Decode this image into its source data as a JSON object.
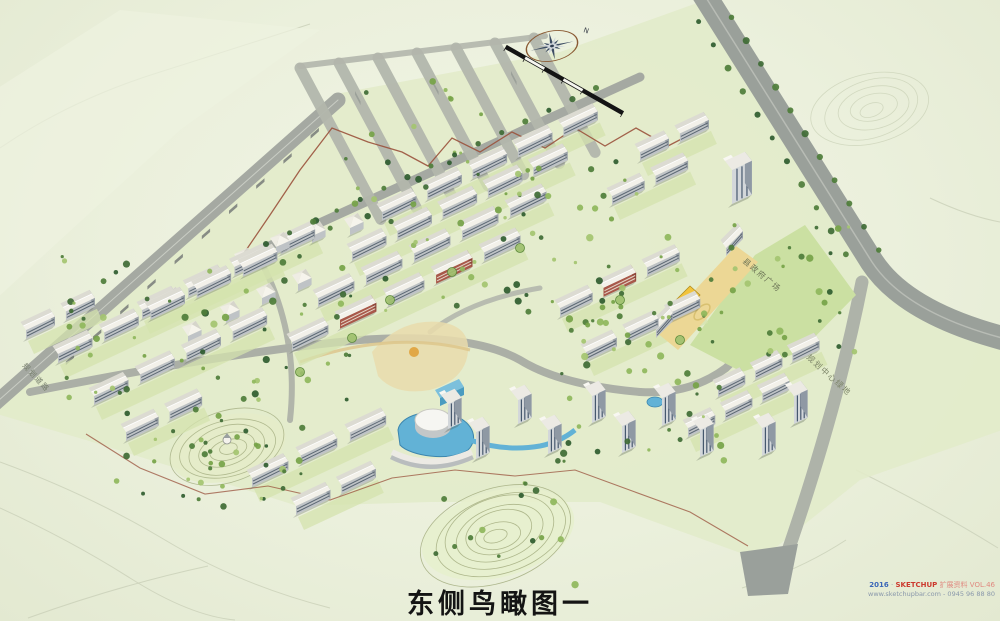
{
  "page": {
    "title": "东侧鸟瞰图一"
  },
  "compass": {
    "north_label": "N"
  },
  "map_labels": {
    "left_road_label": "规划道路",
    "plaza_label": "县政府广场",
    "central_green_label": "规划中心绿地"
  },
  "watermark": {
    "year": "2016",
    "separator": "·",
    "brand": "SKETCHUP",
    "series": "扩展资料 VOL.46",
    "line2": "www.sketchupbar.com - 0945 96 88 80"
  },
  "palette": {
    "paper": "#ecf0de",
    "site_green": "#e2ebca",
    "lawn_green": "#cbe0a2",
    "road_gray": "#a0a59e",
    "building_white": "#f6f4ec",
    "facade_gray": "#bfc3c6",
    "accent_red": "#a8584a",
    "water_blue": "#62b2d6",
    "school_yellow": "#f0c93e",
    "contour_olive": "#a3ad7f",
    "boundary_brown": "#9a523c",
    "title_black": "#141414"
  }
}
